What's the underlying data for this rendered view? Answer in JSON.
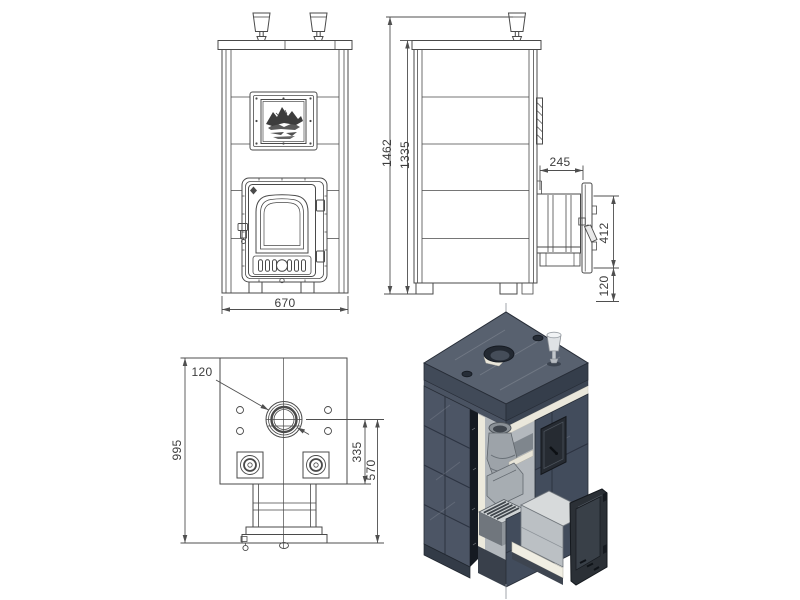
{
  "drawing": {
    "kind": "stove technical drawing with front, side, top views and 3D cutaway",
    "dimensions": {
      "front_width": "670",
      "total_height": "1462",
      "body_height": "1335",
      "firebox_tunnel_depth": "245",
      "firebox_door_height": "412",
      "firebox_door_bottom_offset": "120",
      "plan_chimney_diameter": "120",
      "plan_depth": "995",
      "plan_chimney_offset": "335",
      "plan_firebox_length": "570"
    },
    "colors": {
      "line": "#4a4a4a",
      "dimension_line": "#4f4f4f",
      "text": "#3c3c3c",
      "stone_dark": "#4c5565",
      "stone_top": "#58616f",
      "cut_face": "#161b23",
      "metal_light": "#b4b9bd",
      "insulation_white": "#ece9dc",
      "background": "#ffffff"
    }
  }
}
